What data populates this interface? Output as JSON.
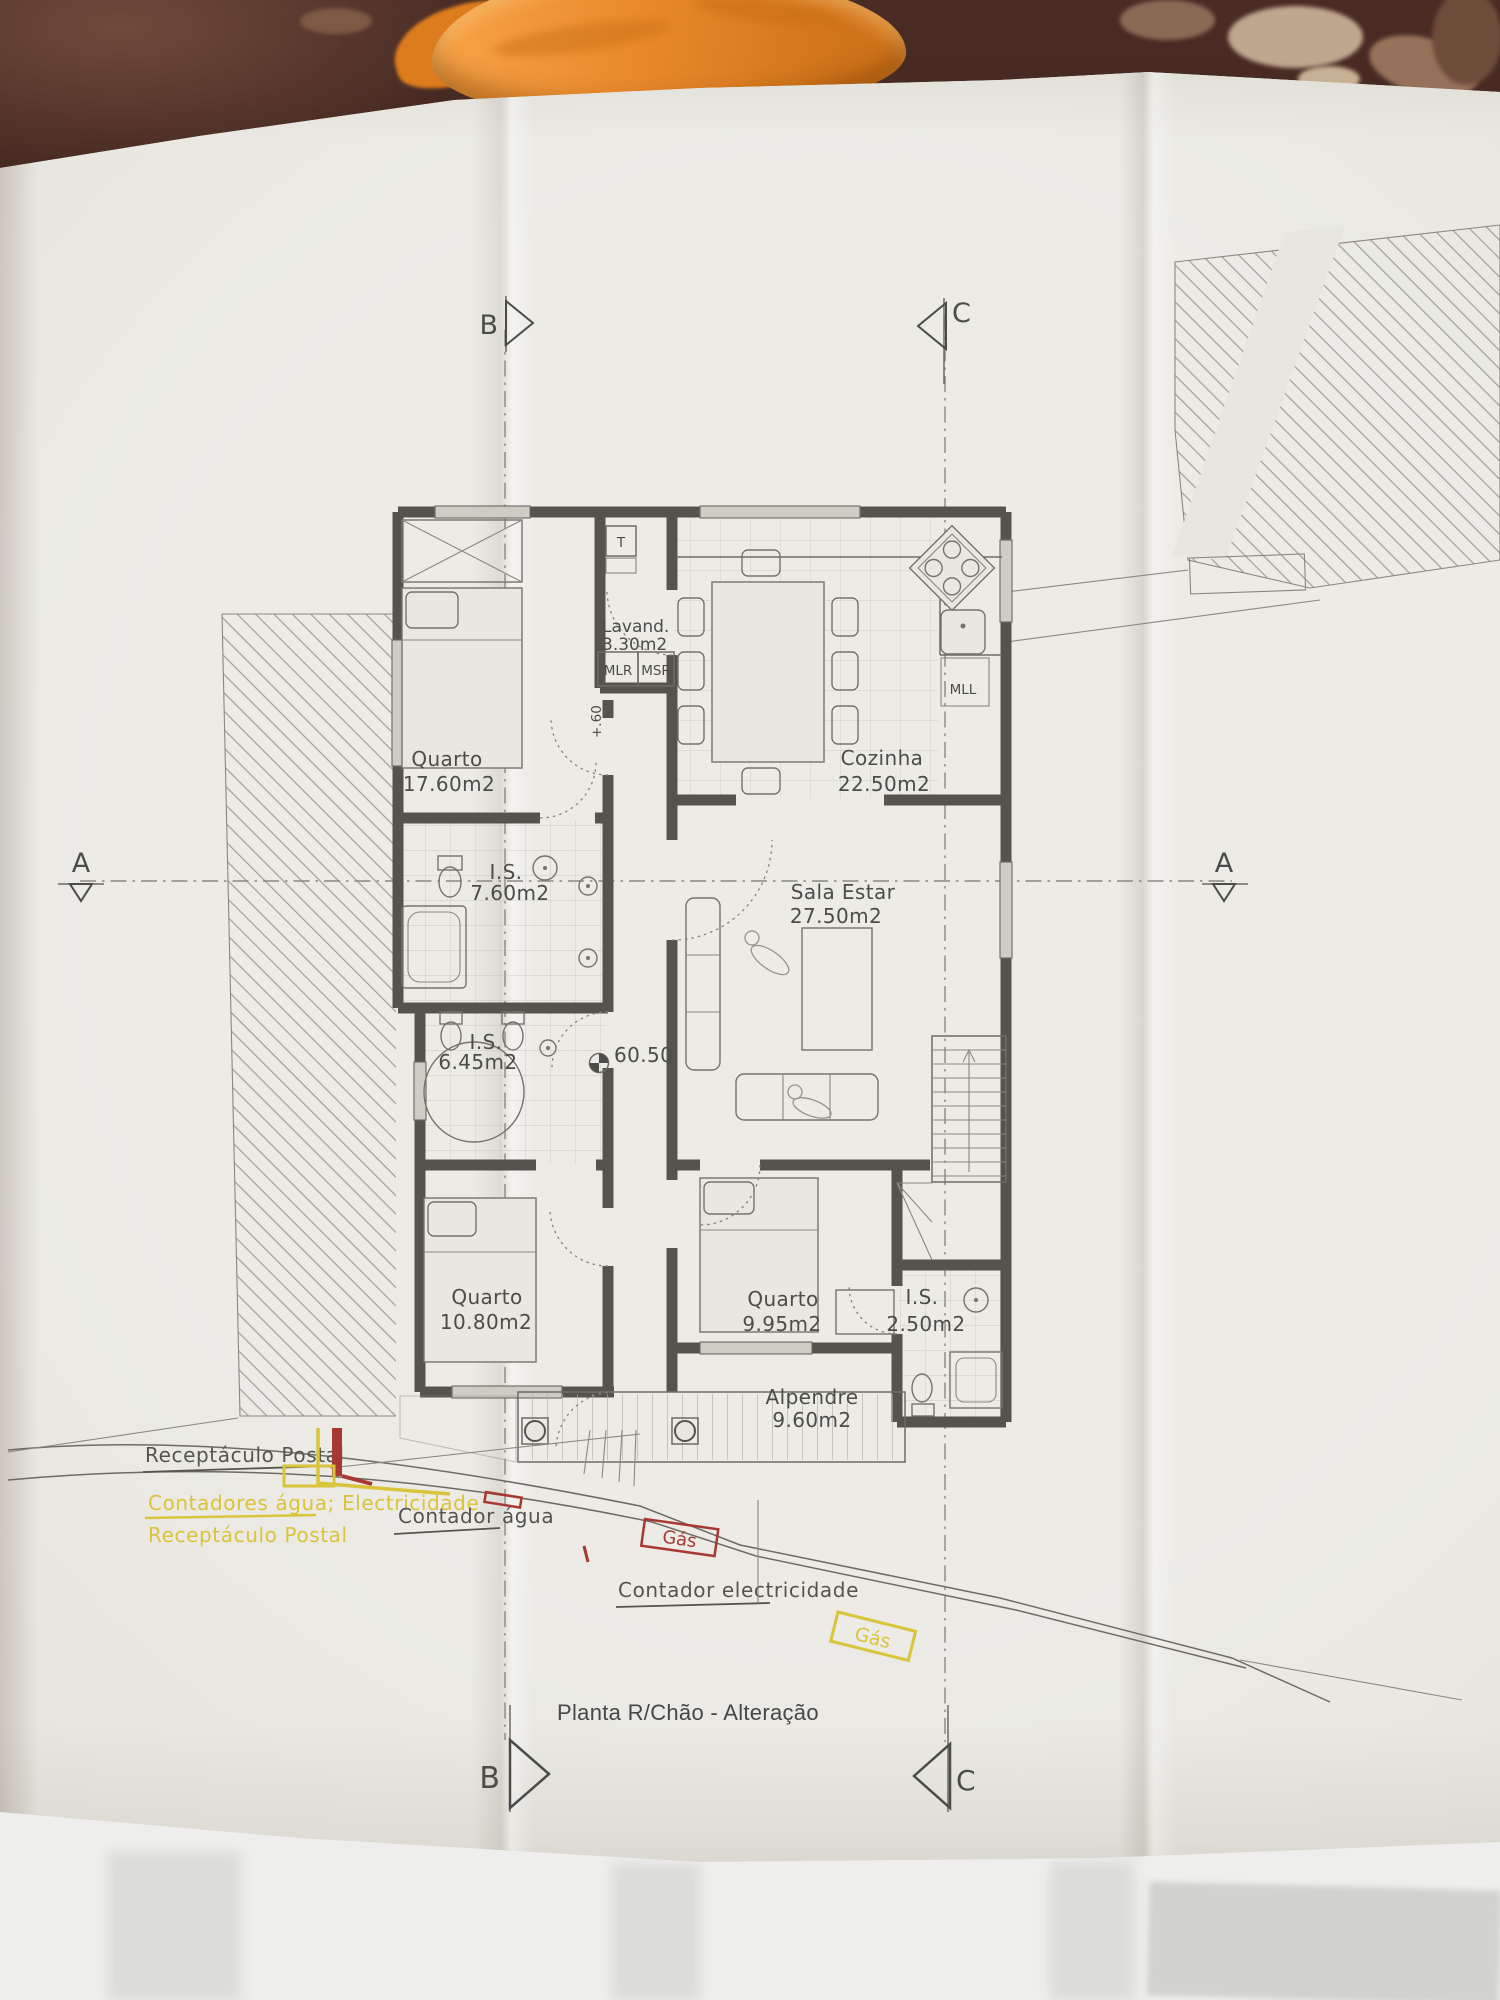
{
  "plan": {
    "title": "Planta R/Chão - Alteração",
    "rooms": {
      "quarto1": {
        "name": "Quarto",
        "area": "17.60m2"
      },
      "lavandaria": {
        "name": "Lavand.",
        "area": "3.30m2"
      },
      "cozinha": {
        "name": "Cozinha",
        "area": "22.50m2"
      },
      "is1": {
        "name": "I.S.",
        "area": "7.60m2"
      },
      "sala": {
        "name": "Sala Estar",
        "area": "27.50m2"
      },
      "is2": {
        "name": "I.S.",
        "area": "6.45m2"
      },
      "quarto2": {
        "name": "Quarto",
        "area": "10.80m2"
      },
      "quarto3": {
        "name": "Quarto",
        "area": "9.95m2"
      },
      "is3": {
        "name": "I.S.",
        "area": "2.50m2"
      },
      "alpendre": {
        "name": "Alpendre",
        "area": "9.60m2"
      }
    },
    "labels": {
      "t": "T",
      "mlr": "MLR",
      "msr": "MSR",
      "mll": "MLL",
      "level_main": "60.50",
      "level_step": "+.60"
    },
    "sections": {
      "a": "A",
      "b": "B",
      "c": "C"
    },
    "annotations": {
      "postal": "Receptáculo Postal",
      "meters": "Contadores água; Electricidade",
      "postal2": "Receptáculo Postal",
      "water": "Contador água",
      "gas1": "Gás",
      "electricity": "Contador electricidade",
      "gas2": "Gás"
    }
  },
  "colors": {
    "paper": "#e8e6e0",
    "ink": "#4c4c48",
    "wall": "#56534c",
    "yellow": "#d9c43a",
    "red": "#a83832",
    "orange": "#e8882b",
    "table": "#4a2c25"
  }
}
